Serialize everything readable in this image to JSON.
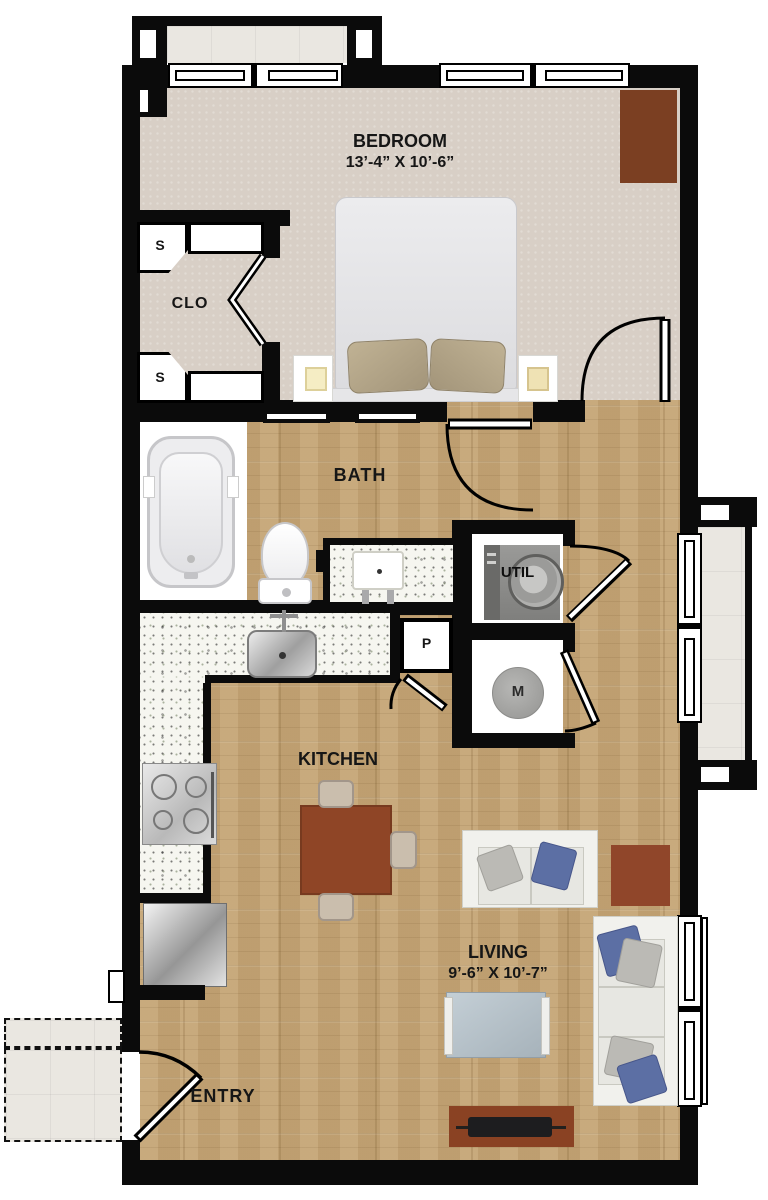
{
  "plan": {
    "type": "apartment-floor-plan",
    "rooms": {
      "bedroom": {
        "name": "BEDROOM",
        "dims": "13’-4” X 10’-6”"
      },
      "closet": {
        "name": "CLO",
        "marker_top": "S",
        "marker_bottom": "S"
      },
      "bath": {
        "name": "BATH"
      },
      "utility": {
        "name": "UTIL"
      },
      "pantry": {
        "name": "P"
      },
      "mechanical": {
        "name": "M"
      },
      "kitchen": {
        "name": "KITCHEN"
      },
      "living": {
        "name": "LIVING",
        "dims": "9’-6” X 10’-7”"
      },
      "entry": {
        "name": "ENTRY"
      }
    },
    "palette": {
      "wall": "#0b0b0b",
      "wood_floor": "#c5a676",
      "carpet": "#d8cfc6",
      "counter_speckle": "#f6f6f0",
      "tile": "#eae7e1",
      "furniture_brown": "#8a4526",
      "pillow_blue": "#5c6fa4",
      "bed_linen": "#e7e7e9",
      "pillow_tan": "#b1a384"
    }
  }
}
